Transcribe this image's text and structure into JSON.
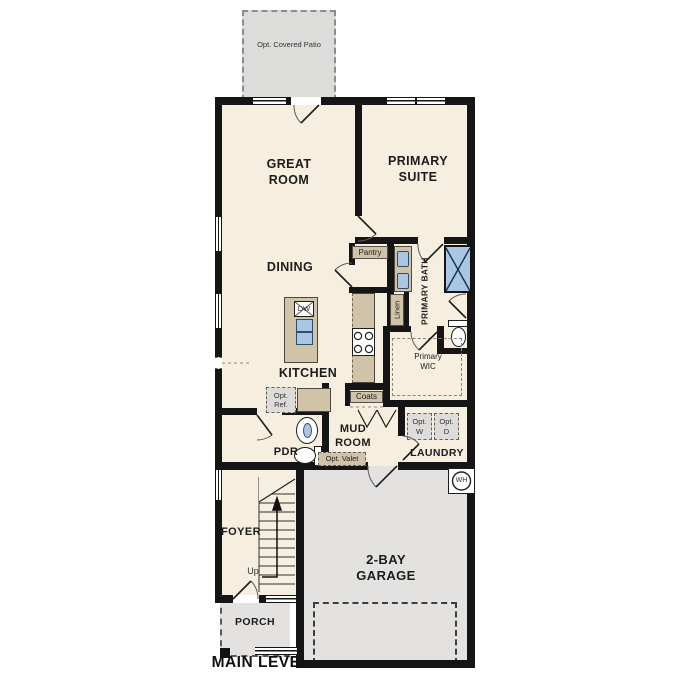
{
  "title": "MAIN LEVEL",
  "labels": {
    "patio": "Opt. Covered Patio",
    "great_room": "GREAT ROOM",
    "primary_suite": "PRIMARY SUITE",
    "dining": "DINING",
    "kitchen": "KITCHEN",
    "pantry": "Pantry",
    "primary_bath": "PRIMARY BATH",
    "linen": "Linen",
    "primary_wic": "Primary WIC",
    "coats": "Coats",
    "opt_ref": "Opt. Ref.",
    "pdr": "PDR",
    "mud_room": "MUD ROOM",
    "opt_valet": "Opt. Valet",
    "opt_washer": "Opt. W",
    "opt_dryer": "Opt. D",
    "laundry": "LAUNDRY",
    "foyer": "FOYER",
    "up": "Up",
    "garage": "2-BAY GARAGE",
    "water_heater": "WH",
    "dishwasher": "DW",
    "porch": "PORCH"
  },
  "colors": {
    "wall": "#151515",
    "floor": "#f6eede",
    "garage_floor": "#e3e2e0",
    "patio_floor": "#dcdcda",
    "cabinet": "#d1c3a7",
    "water_fixture": "#a9c7e2"
  }
}
